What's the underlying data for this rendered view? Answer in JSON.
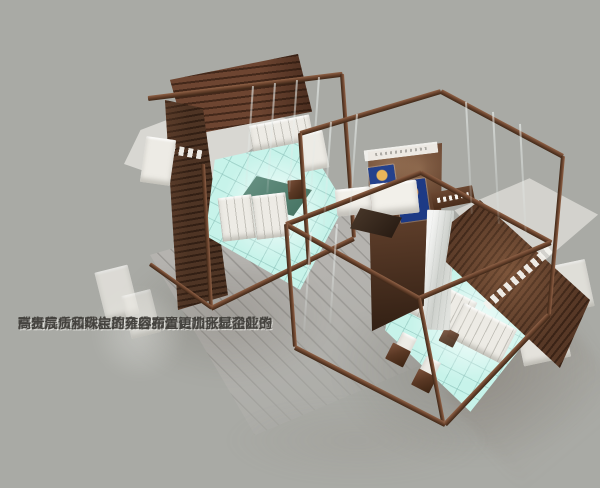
{
  "caption": {
    "lines": [
      "展台方案构思灵感来源于高贵剔透的金",
      "刚石次方晶体。整个展台由四个主要晶体造",
      "型组成，其中主要分为两个洽谈区域和若干",
      "珠宝展示区域，地台的布置更加张显企业的",
      "高贵气质和珠宝的雍容。"
    ],
    "full_text": "展台方案构思灵感来源于高贵剔透的金刚石次方晶体。整个展台由四个主要晶体造型组成，其中主要分为两个洽谈区域和若干珠宝展示区域，地台的布置更加张显企业的高贵气质和珠宝的雍容。"
  },
  "colors": {
    "background": "#a9aaa5",
    "frame_brown": "#6b442e",
    "wall_dark_brown": "#4e3424",
    "floor_glow_cyan": "#c7f3ea",
    "table_teal": "#4f7c6e",
    "cabinet_white": "#edebe5",
    "ceiling_gray": "#d6d5d0",
    "walkway_gray": "#b5b3af",
    "poster_blue": "#24418c",
    "caption_text": "#45433f"
  }
}
